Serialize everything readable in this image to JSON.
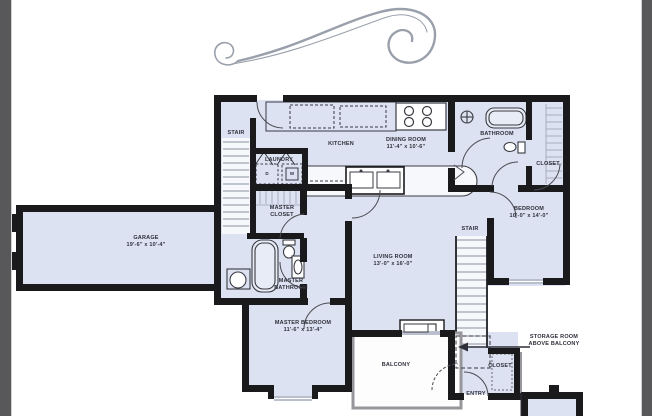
{
  "window": {
    "background": "#ffffff",
    "side_band_color": "#58585a"
  },
  "floorplan": {
    "colors": {
      "room_fill": "#dce2f1",
      "wall": "#1a1a1d",
      "flourish": "#9aa0ab",
      "window_gray": "#b9bfcc"
    },
    "rooms": {
      "stair_left": {
        "name": "STAIR"
      },
      "stair_right": {
        "name": "STAIR"
      },
      "laundry": {
        "name": "LAUNDRY"
      },
      "kitchen": {
        "name": "KITCHEN"
      },
      "dining_room": {
        "name": "DINING ROOM",
        "dims": "11'-4\" x 10'-6\""
      },
      "bathroom": {
        "name": "BATHROOM"
      },
      "closet_upper": {
        "name": "CLOSET"
      },
      "master_closet": {
        "name": "MASTER",
        "name2": "CLOSET"
      },
      "bedroom": {
        "name": "BEDROOM",
        "dims": "10'-0\" x 14'-0\""
      },
      "garage": {
        "name": "GARAGE",
        "dims": "19'-6\" x 10'-4\""
      },
      "living_room": {
        "name": "LIVING ROOM",
        "dims": "13'-0\" x 16'-0\""
      },
      "master_bathroom": {
        "name": "MASTER",
        "name2": "BATHROOM"
      },
      "master_bedroom": {
        "name": "MASTER BEDROOM",
        "dims": "11'-6\" x 13'-4\""
      },
      "balcony": {
        "name": "BALCONY"
      },
      "closet_entry": {
        "name": "CLOSET"
      },
      "entry": {
        "name": "ENTRY"
      },
      "storage_room": {
        "name": "STORAGE ROOM",
        "name2": "ABOVE BALCONY"
      }
    },
    "appliances": {
      "dryer": "D",
      "washer": "W"
    }
  }
}
